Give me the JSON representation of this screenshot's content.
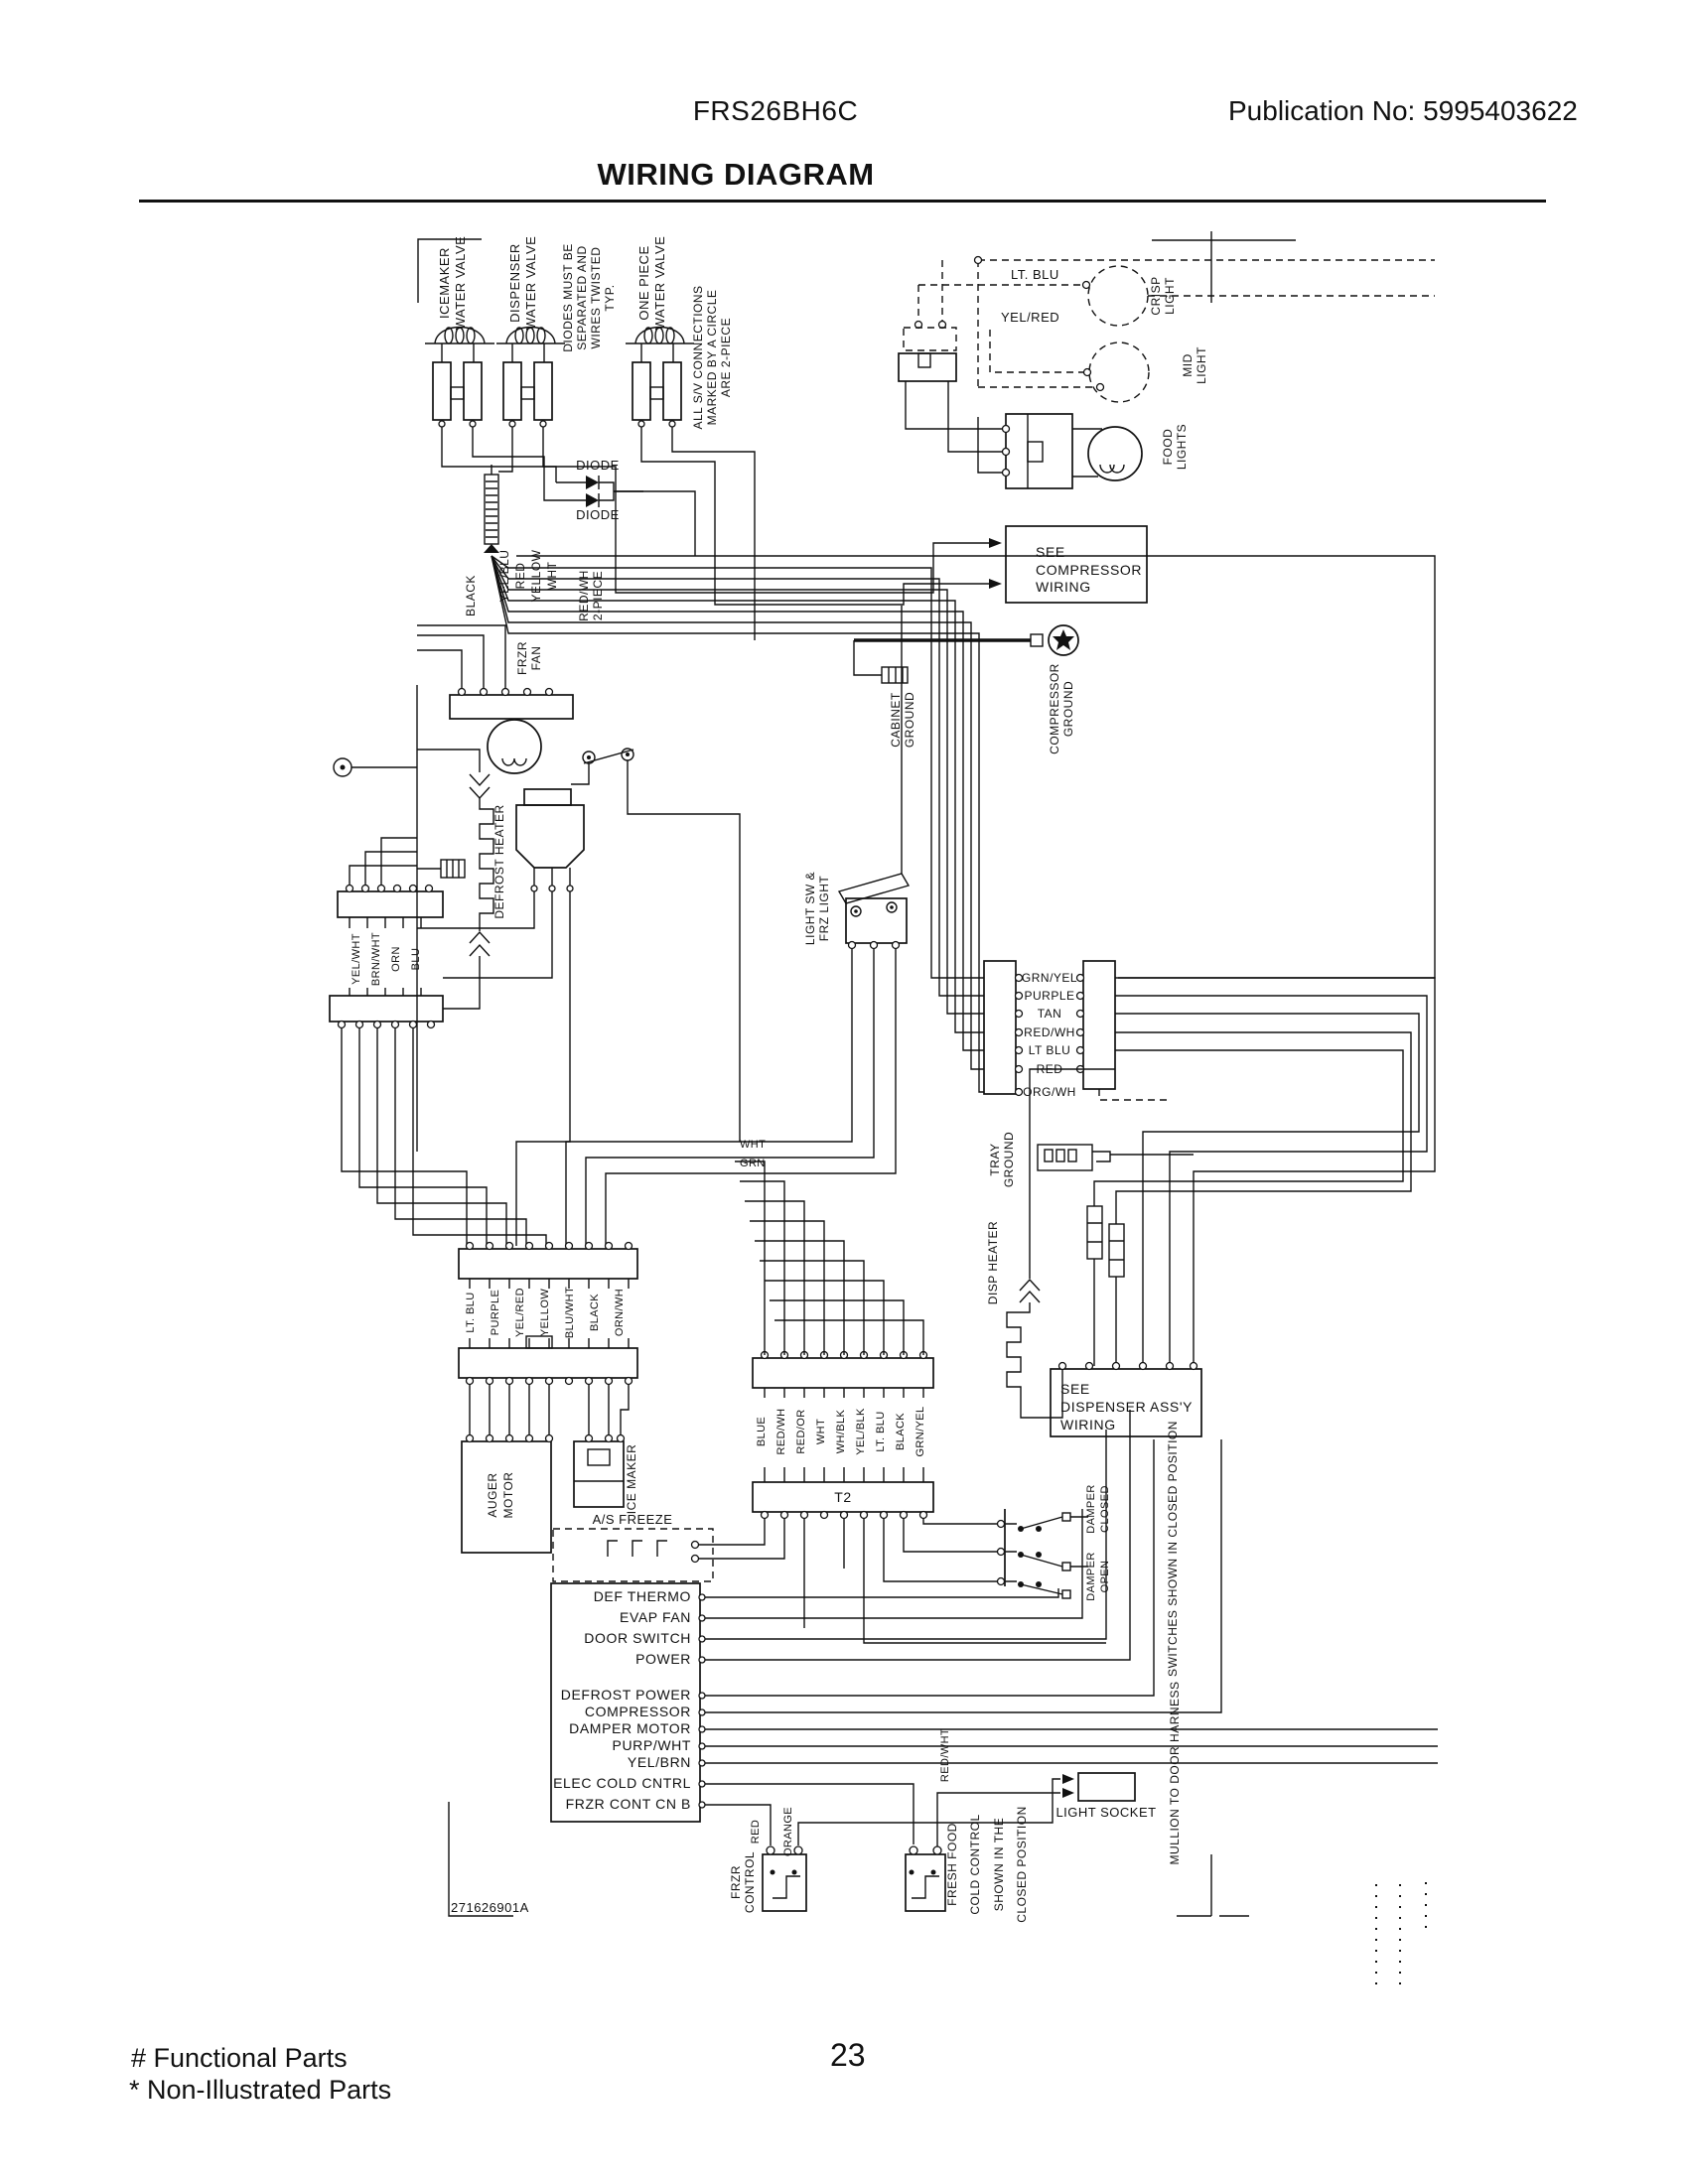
{
  "header": {
    "model": "FRS26BH6C",
    "publication": "Publication No:  5995403622",
    "title": "WIRING DIAGRAM"
  },
  "footer": {
    "functional_parts": "# Functional Parts",
    "non_illustrated_parts": "* Non-Illustrated Parts",
    "page_number": "23"
  },
  "diagram": {
    "part_number": "271626901A",
    "labels": {
      "valve1": [
        "ICEMAKER",
        "WATER VALVE"
      ],
      "valve2": [
        "DISPENSER",
        "WATER VALVE"
      ],
      "valve3": [
        "ONE PIECE",
        "WATER VALVE"
      ],
      "diode_note": [
        "DIODES MUST BE",
        "SEPARATED AND",
        "WIRES TWISTED",
        "TYP."
      ],
      "connection_note": [
        "ALL S/V CONNECTIONS",
        "MARKED BY A CIRCLE",
        "ARE 2-PIECE"
      ],
      "diode": "DIODE",
      "lt_blu": "LT. BLU",
      "yel_red": "YEL/RED",
      "crisp_light": [
        "CRISP",
        "LIGHT"
      ],
      "mid_light": [
        "MID",
        "LIGHT"
      ],
      "food_lights": [
        "FOOD",
        "LIGHTS"
      ],
      "see_compressor": [
        "SEE",
        "COMPRESSOR",
        "WIRING"
      ],
      "compressor_ground": [
        "COMPRESSOR",
        "GROUND"
      ],
      "cabinet_ground": [
        "CABINET",
        "GROUND"
      ],
      "frzr_fan": [
        "FRZR",
        "FAN"
      ],
      "defrost_heater": "DEFROST HEATER",
      "s1_wires": [
        "BLACK",
        "YEL/BLU",
        "RED",
        "YELLOW",
        "WHT"
      ],
      "two_piece": [
        "RED/WH",
        "2-PIECE"
      ],
      "s3_wires": [
        "YEL/WHT",
        "BRN/WHT",
        "ORN",
        "BLU"
      ],
      "light_sw": [
        "LIGHT SW &",
        "FRZ LIGHT"
      ],
      "cp1_wires": [
        "GRN/YEL",
        "PURPLE",
        "TAN",
        "RED/WH",
        "LT BLU",
        "RED",
        "ORG/WH"
      ],
      "tray_ground": [
        "TRAY",
        "GROUND"
      ],
      "disp_heater": "DISP HEATER",
      "pair_wires": [
        "LT. BLU",
        "PURPLE",
        "YEL/RED",
        "YELLOW",
        "BLU/WHT",
        "BLACK",
        "ORN/WH"
      ],
      "auger_motor": [
        "AUGER",
        "MOTOR"
      ],
      "ice_maker": "ICE MAKER",
      "as_freeze": "A/S  FREEZE",
      "t2": "T2",
      "t2_wires": [
        "BLUE",
        "RED/WH",
        "RED/OR",
        "WHT",
        "WH/BLK",
        "YEL/BLK",
        "LT. BLU",
        "BLACK",
        "GRN/YEL"
      ],
      "see_dispenser": [
        "SEE",
        "DISPENSER  ASS'Y",
        "WIRING"
      ],
      "damper_closed": [
        "DAMPER",
        "CLOSED"
      ],
      "damper_open": [
        "DAMPER",
        "OPEN"
      ],
      "damper_note": "SWITCHES SHOWN IN CLOSED POSITION",
      "wht": "WHT",
      "grn": "GRN",
      "board_pins": [
        "DEF THERMO",
        "EVAP FAN",
        "DOOR SWITCH",
        "POWER",
        "DEFROST POWER",
        "COMPRESSOR",
        "DAMPER MOTOR",
        "PURP/WHT",
        "YEL/BRN",
        "ELEC COLD CNTRL",
        "FRZR CONT CN B"
      ],
      "frzr_control": [
        "FRZR",
        "CONTROL"
      ],
      "wire_red": "RED",
      "wire_orange": "ORANGE",
      "ff_note": [
        "FRESH FOOD",
        "COLD CONTROL",
        "SHOWN IN THE",
        "CLOSED POSITION"
      ],
      "red_wht": "RED/WHT",
      "light_socket": "LIGHT  SOCKET",
      "mullion_note": "MULLION TO DOOR HARNESS"
    }
  }
}
